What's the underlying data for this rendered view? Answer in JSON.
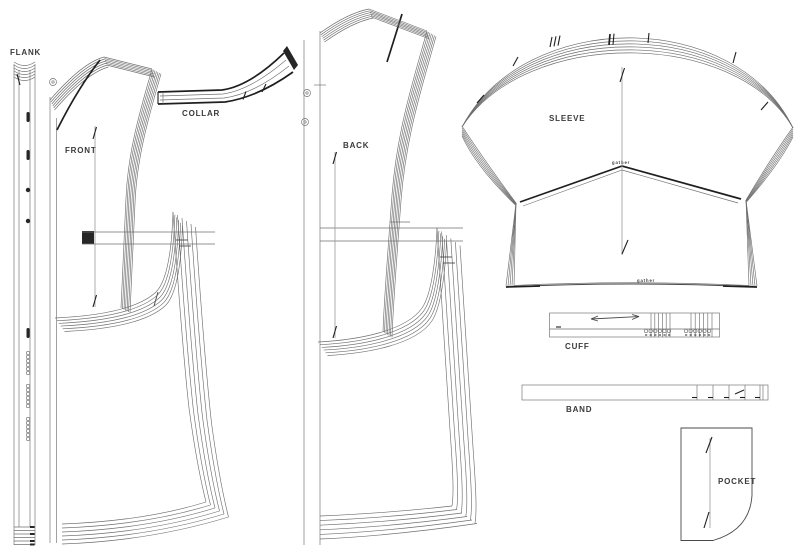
{
  "sheet": {
    "background": "#ffffff",
    "line_color": "#6f6f6f",
    "dark_line_color": "#1f1f1f",
    "label_color": "#3a3a3a"
  },
  "pieces": {
    "flank": {
      "label": "FLANK"
    },
    "front": {
      "label": "FRONT"
    },
    "collar": {
      "label": "COLLAR"
    },
    "back": {
      "label": "BACK"
    },
    "sleeve": {
      "label": "SLEEVE",
      "gather_top": "gather",
      "gather_bottom": "gather"
    },
    "cuff": {
      "label": "CUFF"
    },
    "band": {
      "label": "BAND"
    },
    "pocket": {
      "label": "POCKET"
    }
  }
}
